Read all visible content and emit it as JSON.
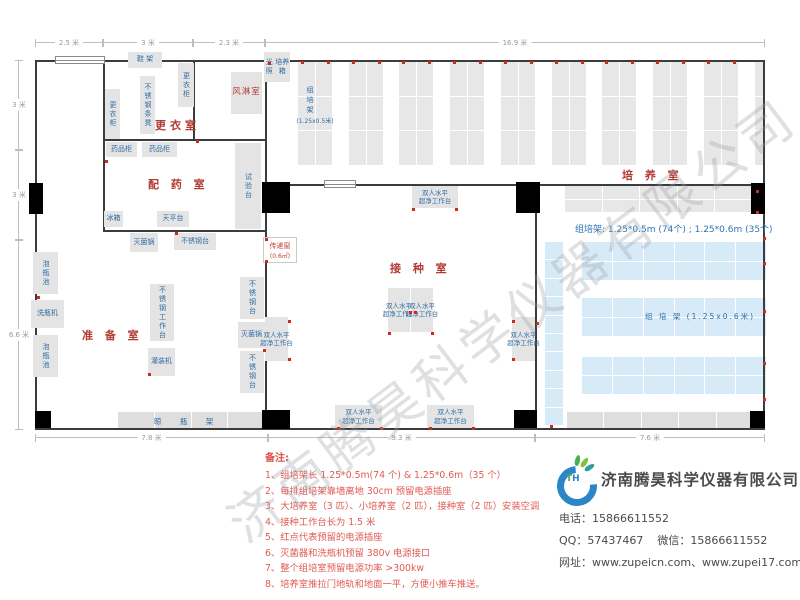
{
  "watermark": "济南腾昊科学仪器有限公司",
  "floorplan": {
    "rooms": [
      {
        "name": "room-label-changing",
        "label": "更衣室",
        "x": 155,
        "y": 117
      },
      {
        "name": "room-label-dispensing",
        "label": "配 药 室",
        "x": 148,
        "y": 176
      },
      {
        "name": "room-label-prep",
        "label": "准 备 室",
        "x": 82,
        "y": 327
      },
      {
        "name": "room-label-inoculation",
        "label": "接 种 室",
        "x": 390,
        "y": 260
      },
      {
        "name": "room-label-culture",
        "label": "培 养 室",
        "x": 622,
        "y": 167
      }
    ],
    "equipment": [
      {
        "label": "鞋 架",
        "x": 128,
        "y": 52,
        "w": 34,
        "h": 16
      },
      {
        "label": "更衣柜",
        "x": 178,
        "y": 63,
        "w": 16,
        "h": 44,
        "v": 1
      },
      {
        "label": "不锈钢条凳",
        "x": 140,
        "y": 76,
        "w": 15,
        "h": 58,
        "v": 1
      },
      {
        "label": "更衣柜",
        "x": 105,
        "y": 89,
        "w": 15,
        "h": 50,
        "v": 1
      },
      {
        "label": "风淋室",
        "x": 231,
        "y": 72,
        "w": 31,
        "h": 42,
        "red": 1
      },
      {
        "label": "光照培养箱",
        "lines": [
          "光照",
          "培养箱"
        ],
        "x": 264,
        "y": 52,
        "w": 26,
        "h": 30
      },
      {
        "label": "药品柜",
        "x": 106,
        "y": 142,
        "w": 31,
        "h": 15
      },
      {
        "label": "药品柜",
        "x": 142,
        "y": 142,
        "w": 35,
        "h": 15
      },
      {
        "label": "冰箱",
        "x": 104,
        "y": 211,
        "w": 19,
        "h": 16
      },
      {
        "label": "天平台",
        "x": 157,
        "y": 211,
        "w": 32,
        "h": 16
      },
      {
        "label": "试验台",
        "x": 235,
        "y": 143,
        "w": 26,
        "h": 86,
        "v": 1
      },
      {
        "label": "灭菌锅",
        "x": 130,
        "y": 233,
        "w": 28,
        "h": 19
      },
      {
        "label": "不锈钢台",
        "x": 174,
        "y": 233,
        "w": 42,
        "h": 17
      },
      {
        "label": "泡瓶池",
        "x": 33,
        "y": 252,
        "w": 25,
        "h": 42,
        "v": 1
      },
      {
        "label": "洗瓶机",
        "x": 31,
        "y": 300,
        "w": 33,
        "h": 28
      },
      {
        "label": "泡瓶池",
        "x": 33,
        "y": 335,
        "w": 25,
        "h": 42,
        "v": 1
      },
      {
        "label": "不锈钢工作台",
        "x": 150,
        "y": 284,
        "w": 24,
        "h": 57,
        "v": 1
      },
      {
        "label": "灌装机",
        "x": 148,
        "y": 348,
        "w": 27,
        "h": 28
      },
      {
        "label": "不锈钢台",
        "x": 240,
        "y": 277,
        "w": 24,
        "h": 42,
        "v": 1
      },
      {
        "label": "灭菌锅",
        "x": 238,
        "y": 322,
        "w": 27,
        "h": 26
      },
      {
        "label": "不锈钢台",
        "x": 240,
        "y": 351,
        "w": 24,
        "h": 42,
        "v": 1
      }
    ],
    "benches": {
      "label_lines": [
        "双人水平",
        "超净工作台"
      ],
      "boxes": [
        [
          412,
          186,
          46,
          22
        ],
        [
          388,
          288,
          22,
          44
        ],
        [
          411,
          288,
          22,
          44
        ],
        [
          265,
          317,
          23,
          44
        ],
        [
          512,
          317,
          23,
          44
        ],
        [
          335,
          405,
          47,
          23
        ],
        [
          427,
          405,
          47,
          23
        ]
      ]
    },
    "drying_rack": {
      "label": "晾 瓶 架",
      "x": 118,
      "y": 412,
      "w": 146,
      "h": 16,
      "cols": 4
    },
    "culture_racks_top": {
      "label": "组培架",
      "sublabel": "(1.25x0.5米)",
      "x0": 298,
      "step": 50.7,
      "count": 9,
      "w": 34,
      "y": 62,
      "h": 103,
      "partial_x": 755,
      "partial_w": 10
    },
    "gray_rack_right": {
      "x": 565,
      "y": 186,
      "w": 187,
      "h": 26,
      "cols": 5,
      "rows": 2
    },
    "blue_racks": {
      "label": "组 培 架 (1.25x0.6米)",
      "rows": [
        [
          582,
          242,
          184,
          38
        ],
        [
          582,
          298,
          184,
          38
        ],
        [
          582,
          357,
          184,
          37
        ]
      ],
      "cols": 6,
      "strip": [
        545,
        242,
        18,
        183
      ],
      "bottom_gray": [
        567,
        412,
        186,
        16
      ]
    },
    "blue_note": "组培架: 1.25*0.5m (74个) ; 1.25*0.6m (35个)",
    "transfer_window": {
      "lines": [
        "传递窗",
        "(0.6㎡)"
      ],
      "x": 263,
      "y": 237,
      "w": 34,
      "h": 26
    },
    "dims_top": [
      {
        "label": "2.5 米",
        "a": 35,
        "b": 103
      },
      {
        "label": "3 米",
        "a": 103,
        "b": 193
      },
      {
        "label": "2.3 米",
        "a": 193,
        "b": 265
      },
      {
        "label": "16.9 米",
        "a": 265,
        "b": 765
      }
    ],
    "dims_left": [
      {
        "label": "3 米",
        "a": 60,
        "b": 150
      },
      {
        "label": "3 米",
        "a": 150,
        "b": 240
      },
      {
        "label": "6.6 米",
        "a": 240,
        "b": 430
      }
    ],
    "dims_bottom": [
      {
        "label": "7.8 米",
        "a": 35,
        "b": 268
      },
      {
        "label": "9.3 米",
        "a": 268,
        "b": 535
      },
      {
        "label": "7.6 米",
        "a": 535,
        "b": 765
      }
    ],
    "outlets": [
      [
        37,
        296
      ],
      [
        148,
        373
      ],
      [
        263,
        349
      ],
      [
        265,
        238
      ],
      [
        265,
        260
      ],
      [
        105,
        160
      ],
      [
        175,
        232
      ],
      [
        412,
        208
      ],
      [
        455,
        208
      ],
      [
        409,
        311
      ],
      [
        414,
        311
      ],
      [
        388,
        332
      ],
      [
        431,
        332
      ],
      [
        288,
        320
      ],
      [
        288,
        358
      ],
      [
        512,
        320
      ],
      [
        512,
        358
      ],
      [
        337,
        427
      ],
      [
        380,
        427
      ],
      [
        429,
        427
      ],
      [
        472,
        427
      ],
      [
        763,
        237
      ],
      [
        763,
        262
      ],
      [
        763,
        310
      ],
      [
        763,
        362
      ],
      [
        763,
        398
      ],
      [
        756,
        190
      ],
      [
        756,
        211
      ],
      [
        550,
        425
      ],
      [
        536,
        322
      ],
      [
        268,
        62
      ],
      [
        196,
        140
      ]
    ]
  },
  "notes": {
    "title": "备注:",
    "items": [
      "1、组培架长 1.25*0.5m(74 个) & 1.25*0.6m（35 个）",
      "2、每排组培架靠墙离地 30cm 预留电源插座",
      "3、大培养室（3 匹）、小培养室（2 匹），接种室（2 匹）安装空调",
      "4、接种工作台长为 1.5 米",
      "5、红点代表预留的电源插座",
      "6、灭菌器和洗瓶机预留 380v 电源接口",
      "7、整个组培室预留电源功率 >300kw",
      "8、培养室推拉门地轨和地面一平，方便小推车推送。"
    ]
  },
  "company": {
    "logo_t": "T",
    "logo_h": "H",
    "name": "济南腾昊科学仪器有限公司",
    "phone_label": "电话：",
    "phone": "15866611552",
    "qq_label": "QQ：",
    "qq": "57437467",
    "wechat_label": "微信：",
    "wechat": "15866611552",
    "web_label": "网址：",
    "websites": "www.zupeicn.com、www.zupei17.com"
  }
}
